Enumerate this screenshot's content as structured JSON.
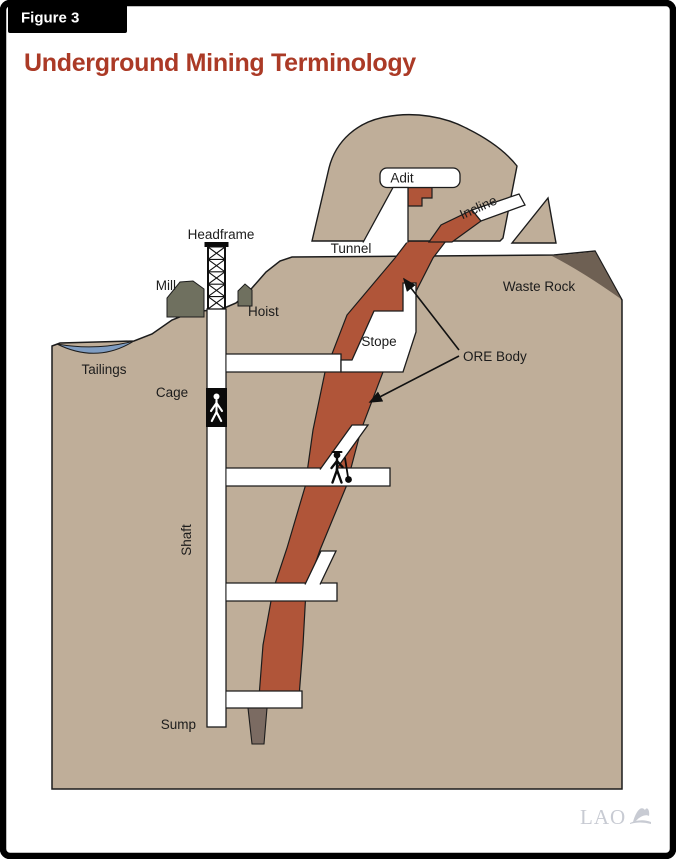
{
  "figure": {
    "label": "Figure 3"
  },
  "title": "Underground Mining Terminology",
  "diagram_labels": {
    "adit": "Adit",
    "incline": "Incline",
    "tunnel": "Tunnel",
    "headframe": "Headframe",
    "mill": "Mill",
    "hoist": "Hoist",
    "waste_rock": "Waste Rock",
    "stope": "Stope",
    "ore_body": "ORE Body",
    "tailings": "Tailings",
    "cage": "Cage",
    "shaft": "Shaft",
    "sump": "Sump"
  },
  "logo": {
    "text": "LAO"
  },
  "colors": {
    "ground": "#bfae99",
    "ore_body": "#b05539",
    "ore_stub": "#7b6b62",
    "waste_rock": "#6e6053",
    "buildings": "#6f705f",
    "tailings_pond": "#7f9dc2",
    "title_red": "#ab3a26",
    "outline": "#1c1c1c",
    "logo_gray": "#c8cbd3"
  }
}
